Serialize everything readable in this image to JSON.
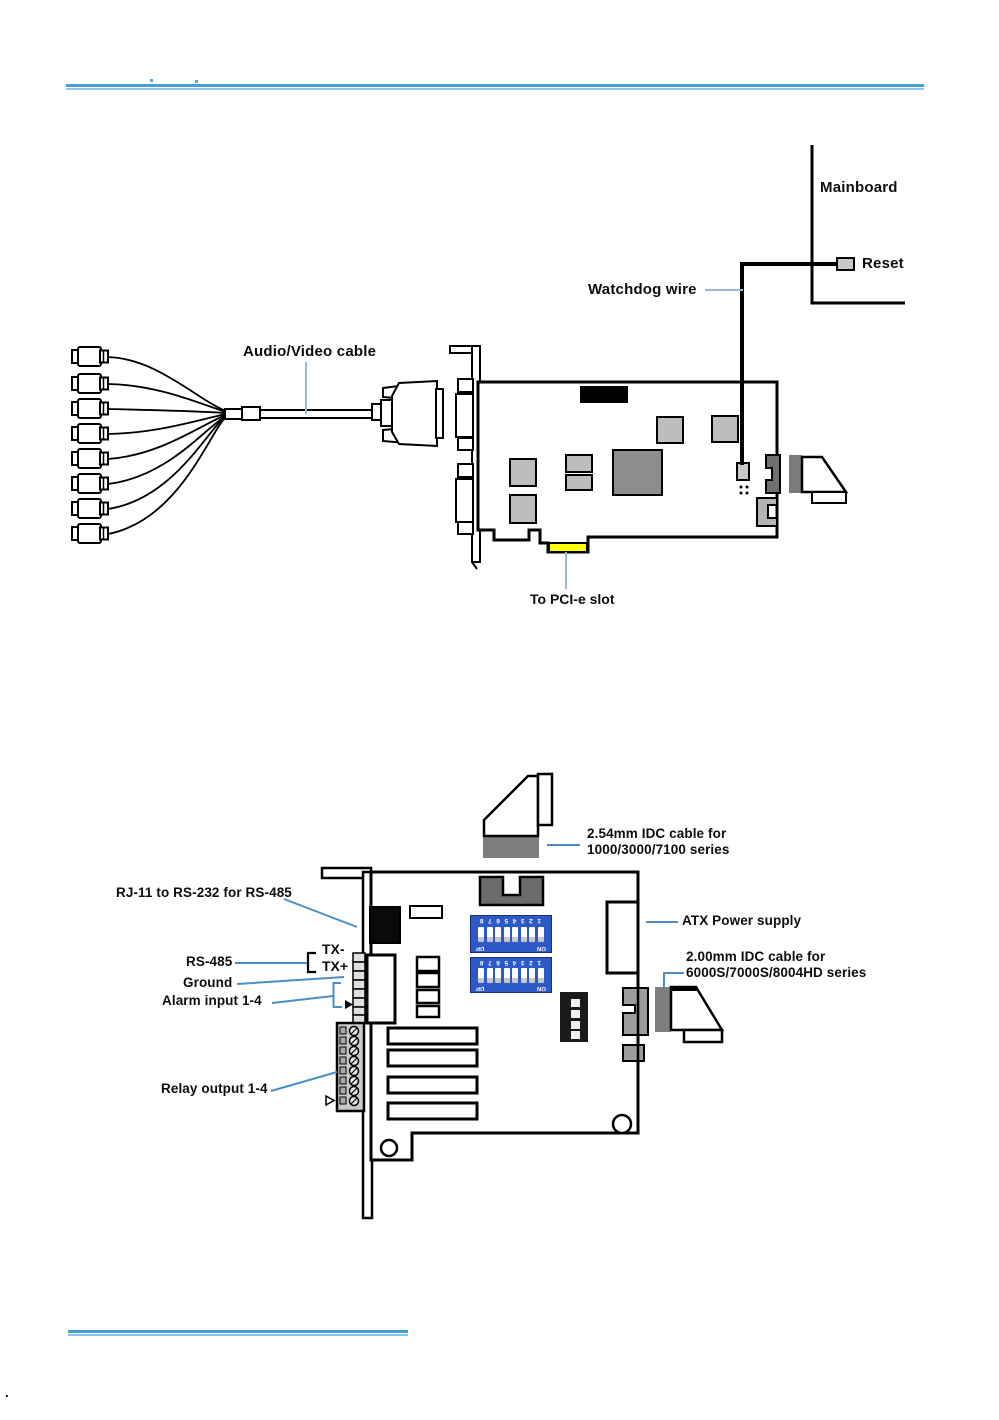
{
  "page": {
    "rule_color_primary": "#459fd8",
    "rule_color_secondary": "#8ec4ea",
    "stray_dot": "."
  },
  "figure_top": {
    "labels": {
      "mainboard": "Mainboard",
      "reset": "Reset",
      "watchdog_wire": "Watchdog wire",
      "audio_video_cable": "Audio/Video cable",
      "to_pcie_slot": "To PCI-e slot"
    },
    "colors": {
      "pcie_edge_connector": "#ffff00",
      "leader_line": "#9cb8d4"
    }
  },
  "figure_bottom": {
    "labels": {
      "idc254_line1": "2.54mm IDC cable for",
      "idc254_line2": "1000/3000/7100 series",
      "rj11_rs232": "RJ-11 to RS-232 for RS-485",
      "rs485": "RS-485",
      "tx_minus": "TX-",
      "tx_plus": "TX+",
      "ground": "Ground",
      "alarm_input": "Alarm input 1-4",
      "relay_output": "Relay output 1-4",
      "atx_power": "ATX Power supply",
      "idc200_line1": "2.00mm IDC cable for",
      "idc200_line2": "6000S/7000S/8004HD series"
    },
    "dip_switch": {
      "numbers": "12345678",
      "on_label": "ON",
      "dp_label": "DP"
    },
    "colors": {
      "dip_blue": "#2c58c8",
      "leader_line": "#4a8fc4"
    }
  }
}
